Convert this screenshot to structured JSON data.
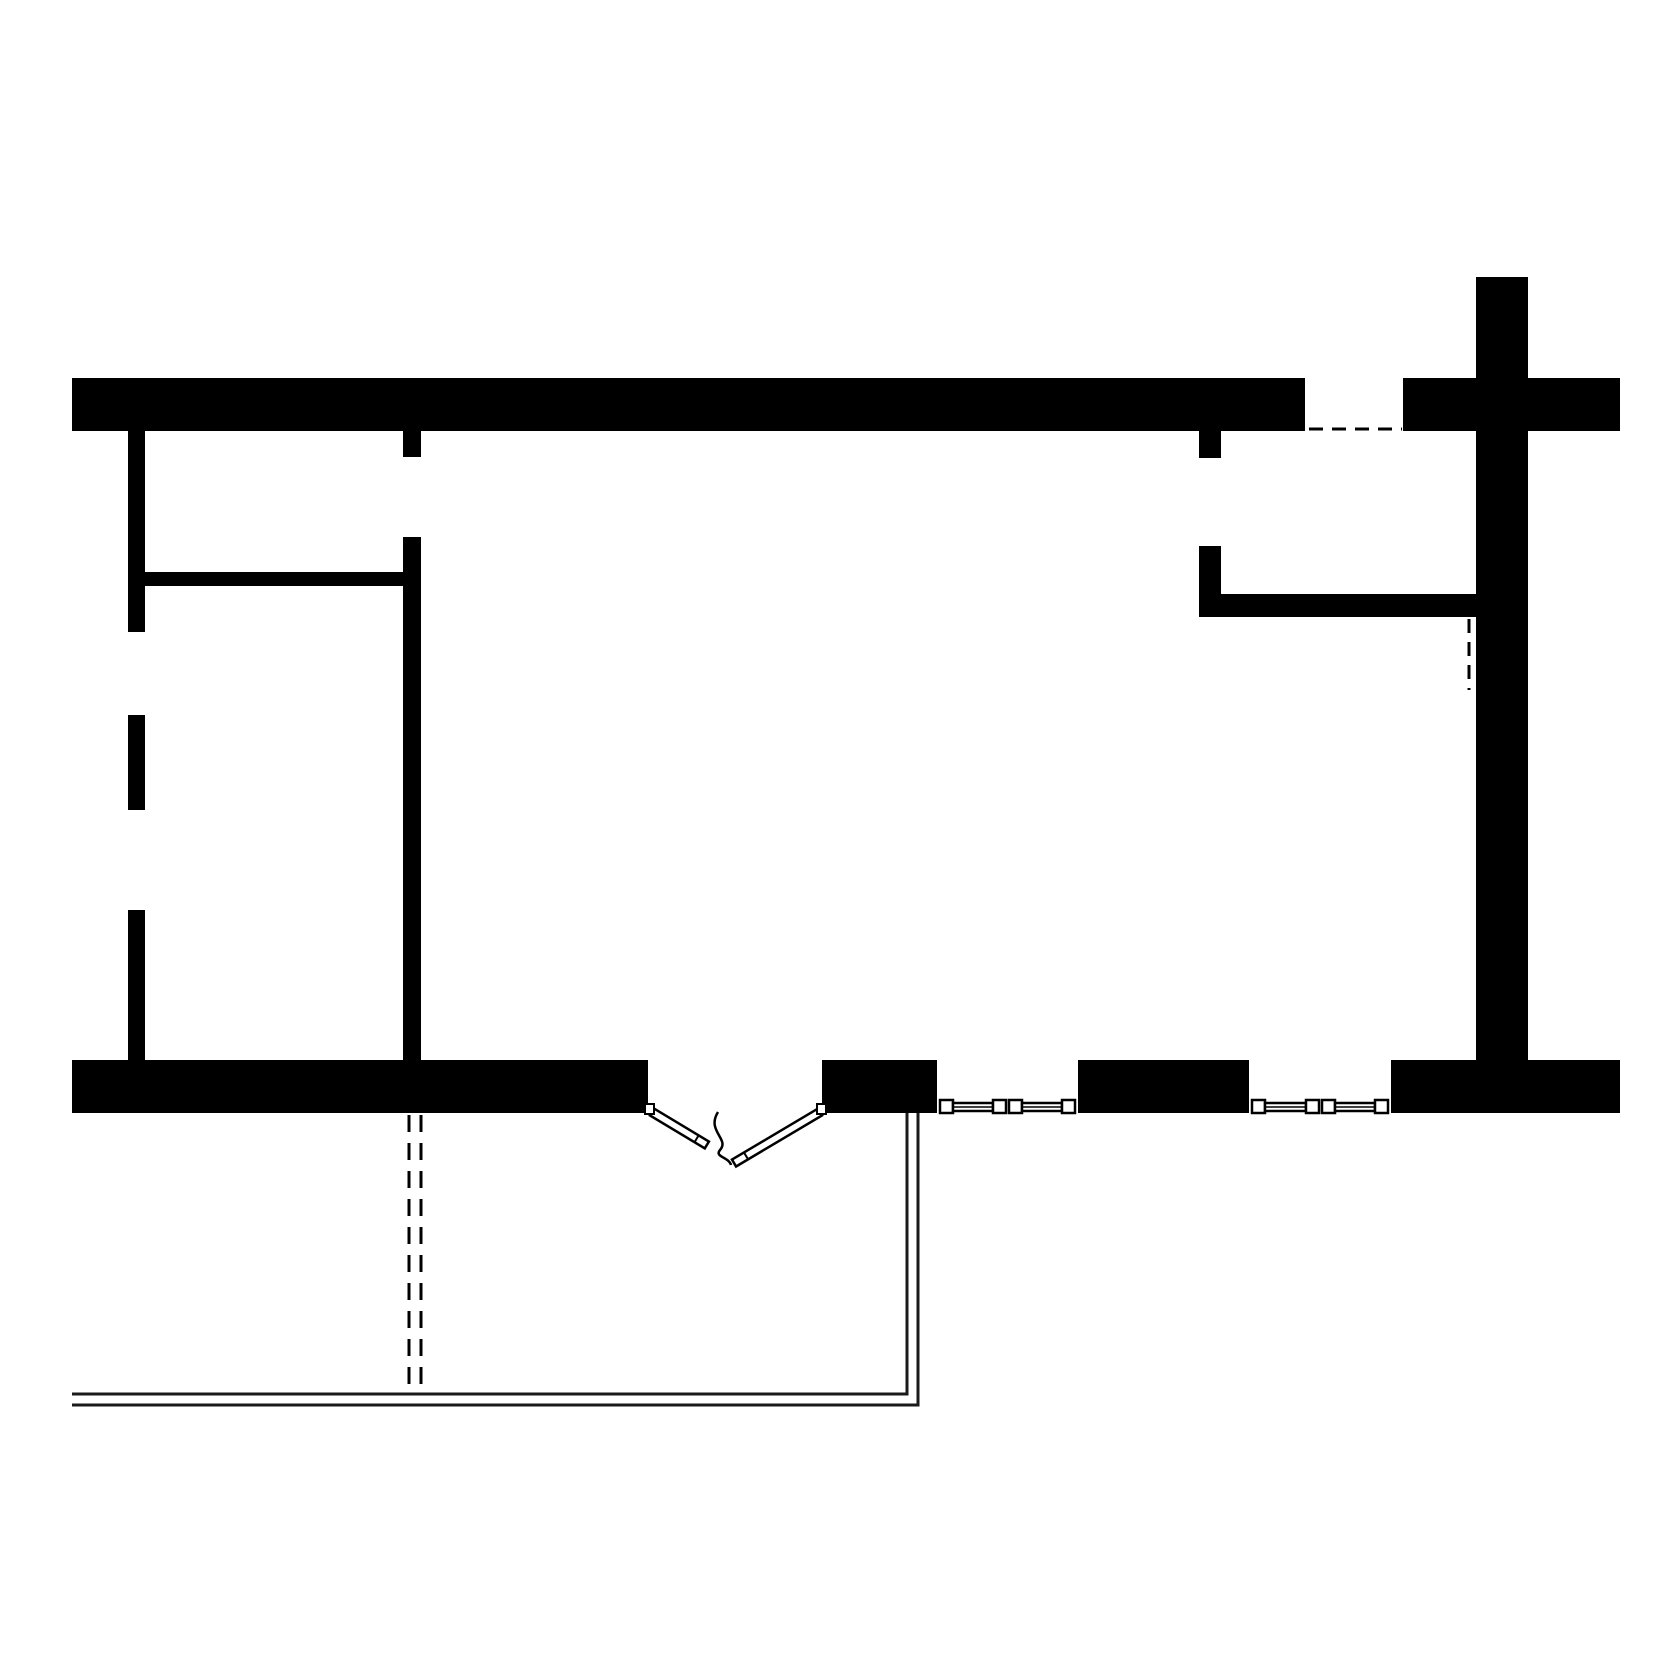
{
  "canvas": {
    "width": 1680,
    "height": 1680,
    "background": "#ffffff",
    "ink": "#000000",
    "thin_line": "#1a1a1a"
  },
  "plan": {
    "shapes": [
      {
        "name": "top-wall",
        "type": "rect",
        "attrs": {
          "x": 72,
          "y": 378,
          "width": 1233,
          "height": 53,
          "fill": "#000000"
        }
      },
      {
        "name": "top-right-wall",
        "type": "rect",
        "attrs": {
          "x": 1403,
          "y": 378,
          "width": 217,
          "height": 53,
          "fill": "#000000"
        }
      },
      {
        "name": "right-wall",
        "type": "rect",
        "attrs": {
          "x": 1476,
          "y": 277,
          "width": 52,
          "height": 783,
          "fill": "#000000"
        }
      },
      {
        "name": "bottom-wall-left",
        "type": "rect",
        "attrs": {
          "x": 72,
          "y": 1060,
          "width": 576,
          "height": 53,
          "fill": "#000000"
        }
      },
      {
        "name": "bottom-wall-mid-a",
        "type": "rect",
        "attrs": {
          "x": 822,
          "y": 1060,
          "width": 115,
          "height": 53,
          "fill": "#000000"
        }
      },
      {
        "name": "bottom-wall-mid-b",
        "type": "rect",
        "attrs": {
          "x": 1078,
          "y": 1060,
          "width": 171,
          "height": 53,
          "fill": "#000000"
        }
      },
      {
        "name": "bottom-wall-right",
        "type": "rect",
        "attrs": {
          "x": 1391,
          "y": 1060,
          "width": 229,
          "height": 53,
          "fill": "#000000"
        }
      },
      {
        "name": "left-wall-upper",
        "type": "rect",
        "attrs": {
          "x": 128,
          "y": 431,
          "width": 17,
          "height": 201,
          "fill": "#000000"
        }
      },
      {
        "name": "left-wall-middle",
        "type": "rect",
        "attrs": {
          "x": 128,
          "y": 715,
          "width": 17,
          "height": 95,
          "fill": "#000000"
        }
      },
      {
        "name": "left-wall-lower",
        "type": "rect",
        "attrs": {
          "x": 128,
          "y": 910,
          "width": 17,
          "height": 150,
          "fill": "#000000"
        }
      },
      {
        "name": "partition-horizontal-left",
        "type": "rect",
        "attrs": {
          "x": 145,
          "y": 572,
          "width": 258,
          "height": 14,
          "fill": "#000000"
        }
      },
      {
        "name": "partition-stub-top",
        "type": "rect",
        "attrs": {
          "x": 403,
          "y": 431,
          "width": 18,
          "height": 26,
          "fill": "#000000"
        }
      },
      {
        "name": "partition-vertical-main",
        "type": "rect",
        "attrs": {
          "x": 403,
          "y": 537,
          "width": 18,
          "height": 523,
          "fill": "#000000"
        }
      },
      {
        "name": "hall-stub-top",
        "type": "rect",
        "attrs": {
          "x": 1199,
          "y": 431,
          "width": 22,
          "height": 27,
          "fill": "#000000"
        }
      },
      {
        "name": "closet-wall-vertical",
        "type": "rect",
        "attrs": {
          "x": 1199,
          "y": 546,
          "width": 22,
          "height": 71,
          "fill": "#000000"
        }
      },
      {
        "name": "closet-wall-horizontal",
        "type": "rect",
        "attrs": {
          "x": 1221,
          "y": 594,
          "width": 255,
          "height": 23,
          "fill": "#000000"
        }
      },
      {
        "name": "deck-edge-inner",
        "type": "polyline",
        "attrs": {
          "points": "907,1113 907,1394 72,1394",
          "fill": "none",
          "stroke": "#1a1a1a",
          "stroke-width": 3
        }
      },
      {
        "name": "deck-edge-outer",
        "type": "polyline",
        "attrs": {
          "points": "918,1113 918,1405 72,1405",
          "fill": "none",
          "stroke": "#1a1a1a",
          "stroke-width": 3
        }
      },
      {
        "name": "dashed-opening-top-right",
        "type": "line",
        "attrs": {
          "x1": 1309,
          "y1": 429,
          "x2": 1402,
          "y2": 429,
          "stroke": "#000000",
          "stroke-width": 3,
          "stroke-dasharray": "14 9"
        }
      },
      {
        "name": "dashed-projection-right",
        "type": "line",
        "attrs": {
          "x1": 1469,
          "y1": 619,
          "x2": 1469,
          "y2": 690,
          "stroke": "#000000",
          "stroke-width": 3,
          "stroke-dasharray": "14 9"
        }
      },
      {
        "name": "dashed-projection-left-a",
        "type": "line",
        "attrs": {
          "x1": 409,
          "y1": 1115,
          "x2": 409,
          "y2": 1394,
          "stroke": "#000000",
          "stroke-width": 3,
          "stroke-dasharray": "17 11"
        }
      },
      {
        "name": "dashed-projection-left-b",
        "type": "line",
        "attrs": {
          "x1": 421,
          "y1": 1115,
          "x2": 421,
          "y2": 1394,
          "stroke": "#000000",
          "stroke-width": 3,
          "stroke-dasharray": "17 11"
        }
      },
      {
        "name": "window-sill-tick-1-left",
        "type": "line",
        "attrs": {
          "x1": 925,
          "y1": 1111,
          "x2": 937,
          "y2": 1111,
          "stroke": "#000000",
          "stroke-width": 2
        }
      },
      {
        "name": "window-sill-tick-1-right",
        "type": "line",
        "attrs": {
          "x1": 1078,
          "y1": 1111,
          "x2": 1090,
          "y2": 1111,
          "stroke": "#000000",
          "stroke-width": 2
        }
      },
      {
        "name": "window-sill-tick-2-left",
        "type": "line",
        "attrs": {
          "x1": 1237,
          "y1": 1111,
          "x2": 1249,
          "y2": 1111,
          "stroke": "#000000",
          "stroke-width": 2
        }
      },
      {
        "name": "window-sill-tick-2-right",
        "type": "line",
        "attrs": {
          "x1": 1391,
          "y1": 1111,
          "x2": 1403,
          "y2": 1111,
          "stroke": "#000000",
          "stroke-width": 2
        }
      },
      {
        "name": "window-1-end-cap-left",
        "type": "rect",
        "attrs": {
          "x": 940,
          "y": 1100,
          "width": 13,
          "height": 13,
          "fill": "#ffffff",
          "stroke": "#000000",
          "stroke-width": 2.5
        }
      },
      {
        "name": "window-1-sash-left",
        "type": "rect",
        "attrs": {
          "x": 953,
          "y": 1103,
          "width": 40,
          "height": 8,
          "fill": "#ffffff",
          "stroke": "#000000",
          "stroke-width": 2.5
        }
      },
      {
        "name": "window-1-sash-left-line",
        "type": "line",
        "attrs": {
          "x1": 953,
          "y1": 1107,
          "x2": 993,
          "y2": 1107,
          "stroke": "#000000",
          "stroke-width": 1.5
        }
      },
      {
        "name": "window-1-mid-cap-left",
        "type": "rect",
        "attrs": {
          "x": 993,
          "y": 1100,
          "width": 13,
          "height": 13,
          "fill": "#ffffff",
          "stroke": "#000000",
          "stroke-width": 2.5
        }
      },
      {
        "name": "window-1-mid-cap-right",
        "type": "rect",
        "attrs": {
          "x": 1009,
          "y": 1100,
          "width": 13,
          "height": 13,
          "fill": "#ffffff",
          "stroke": "#000000",
          "stroke-width": 2.5
        }
      },
      {
        "name": "window-1-sash-right",
        "type": "rect",
        "attrs": {
          "x": 1022,
          "y": 1103,
          "width": 40,
          "height": 8,
          "fill": "#ffffff",
          "stroke": "#000000",
          "stroke-width": 2.5
        }
      },
      {
        "name": "window-1-sash-right-line",
        "type": "line",
        "attrs": {
          "x1": 1022,
          "y1": 1107,
          "x2": 1062,
          "y2": 1107,
          "stroke": "#000000",
          "stroke-width": 1.5
        }
      },
      {
        "name": "window-1-end-cap-right",
        "type": "rect",
        "attrs": {
          "x": 1062,
          "y": 1100,
          "width": 13,
          "height": 13,
          "fill": "#ffffff",
          "stroke": "#000000",
          "stroke-width": 2.5
        }
      },
      {
        "name": "window-2-end-cap-left",
        "type": "rect",
        "attrs": {
          "x": 1252,
          "y": 1100,
          "width": 13,
          "height": 13,
          "fill": "#ffffff",
          "stroke": "#000000",
          "stroke-width": 2.5
        }
      },
      {
        "name": "window-2-sash-left",
        "type": "rect",
        "attrs": {
          "x": 1265,
          "y": 1103,
          "width": 41,
          "height": 8,
          "fill": "#ffffff",
          "stroke": "#000000",
          "stroke-width": 2.5
        }
      },
      {
        "name": "window-2-sash-left-line",
        "type": "line",
        "attrs": {
          "x1": 1265,
          "y1": 1107,
          "x2": 1306,
          "y2": 1107,
          "stroke": "#000000",
          "stroke-width": 1.5
        }
      },
      {
        "name": "window-2-mid-cap-left",
        "type": "rect",
        "attrs": {
          "x": 1306,
          "y": 1100,
          "width": 13,
          "height": 13,
          "fill": "#ffffff",
          "stroke": "#000000",
          "stroke-width": 2.5
        }
      },
      {
        "name": "window-2-mid-cap-right",
        "type": "rect",
        "attrs": {
          "x": 1322,
          "y": 1100,
          "width": 13,
          "height": 13,
          "fill": "#ffffff",
          "stroke": "#000000",
          "stroke-width": 2.5
        }
      },
      {
        "name": "window-2-sash-right",
        "type": "rect",
        "attrs": {
          "x": 1335,
          "y": 1103,
          "width": 40,
          "height": 8,
          "fill": "#ffffff",
          "stroke": "#000000",
          "stroke-width": 2.5
        }
      },
      {
        "name": "window-2-sash-right-line",
        "type": "line",
        "attrs": {
          "x1": 1335,
          "y1": 1107,
          "x2": 1375,
          "y2": 1107,
          "stroke": "#000000",
          "stroke-width": 1.5
        }
      },
      {
        "name": "window-2-end-cap-right",
        "type": "rect",
        "attrs": {
          "x": 1375,
          "y": 1100,
          "width": 13,
          "height": 13,
          "fill": "#ffffff",
          "stroke": "#000000",
          "stroke-width": 2.5
        }
      },
      {
        "name": "door-leaf-left",
        "type": "rect",
        "attrs": {
          "x": 652,
          "y": 1108,
          "width": 64,
          "height": 8,
          "fill": "#ffffff",
          "stroke": "#000000",
          "stroke-width": 2.5,
          "transform": "rotate(31 652 1112)"
        }
      },
      {
        "name": "door-leaf-left-cap",
        "type": "line",
        "attrs": {
          "x1": 704,
          "y1": 1108,
          "x2": 704,
          "y2": 1116,
          "stroke": "#000000",
          "stroke-width": 2,
          "transform": "rotate(31 652 1112)"
        }
      },
      {
        "name": "door-leaf-right",
        "type": "rect",
        "attrs": {
          "x": 820,
          "y": 1108,
          "width": 100,
          "height": 8,
          "fill": "#ffffff",
          "stroke": "#000000",
          "stroke-width": 2.5,
          "transform": "rotate(149.3 820 1112)"
        }
      },
      {
        "name": "door-leaf-right-cap",
        "type": "line",
        "attrs": {
          "x1": 906,
          "y1": 1108,
          "x2": 906,
          "y2": 1116,
          "stroke": "#000000",
          "stroke-width": 2,
          "transform": "rotate(149.3 820 1112)"
        }
      },
      {
        "name": "door-hinge-left",
        "type": "rect",
        "attrs": {
          "x": 645,
          "y": 1104,
          "width": 9,
          "height": 10,
          "fill": "#ffffff",
          "stroke": "#000000",
          "stroke-width": 2
        }
      },
      {
        "name": "door-hinge-right",
        "type": "rect",
        "attrs": {
          "x": 817,
          "y": 1104,
          "width": 9,
          "height": 10,
          "fill": "#ffffff",
          "stroke": "#000000",
          "stroke-width": 2
        }
      },
      {
        "name": "door-meeting-curve",
        "type": "path",
        "attrs": {
          "d": "M 718 1112 C 706 1131 730 1139 720 1150 C 714 1157 729 1157 731 1165",
          "fill": "none",
          "stroke": "#000000",
          "stroke-width": 2.5
        }
      }
    ]
  }
}
